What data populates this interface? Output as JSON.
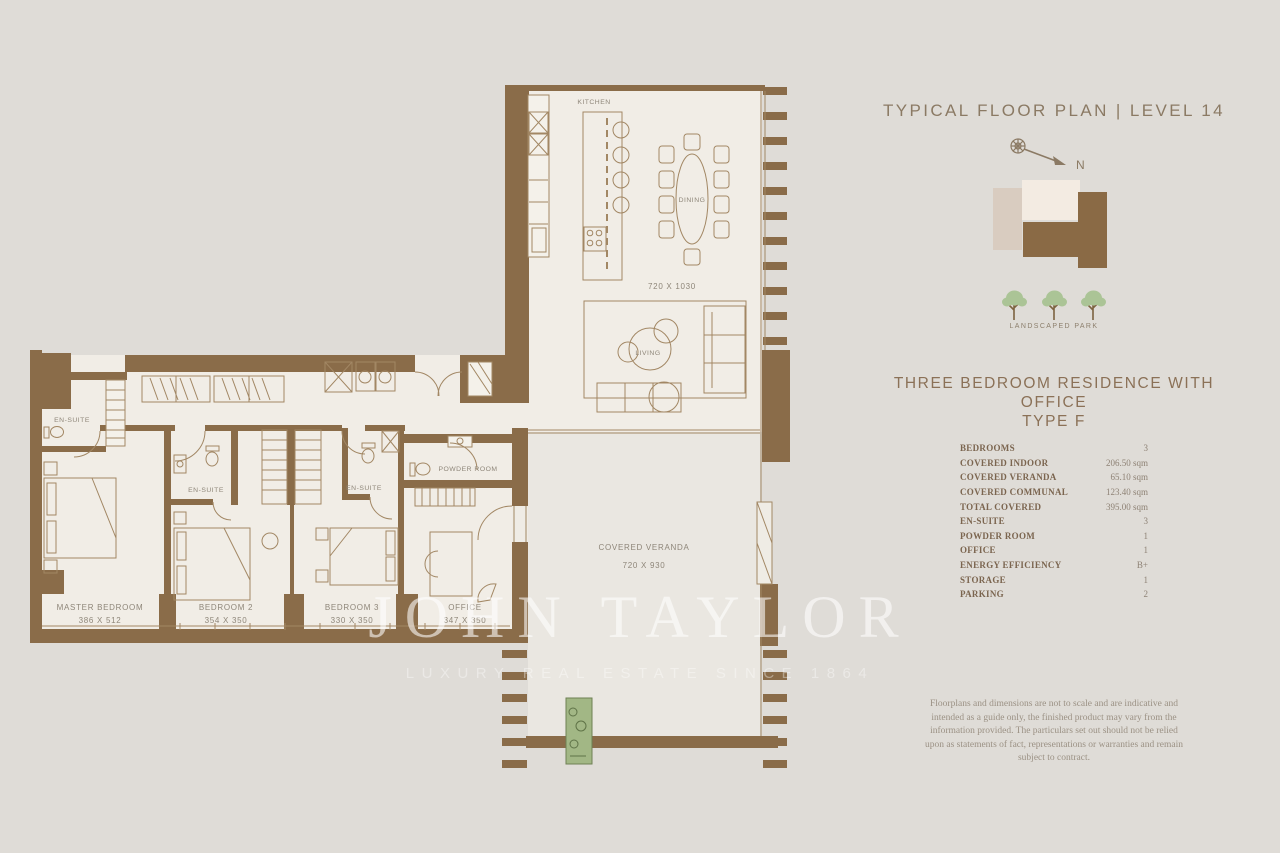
{
  "plan": {
    "labels": {
      "kitchen": "KITCHEN",
      "dining": "DINING",
      "dining_area_dims": "720 X 1030",
      "living": "LIVING",
      "covered_veranda": "COVERED VERANDA",
      "veranda_dims": "720 X 930",
      "master_bedroom": "MASTER BEDROOM",
      "master_dims": "386 X 512",
      "bedroom2": "BEDROOM 2",
      "bedroom2_dims": "354 X 350",
      "bedroom3": "BEDROOM 3",
      "bedroom3_dims": "330 X 350",
      "office": "OFFICE",
      "office_dims": "347 X 350",
      "ensuite_master": "EN-SUITE",
      "ensuite_bedroom2": "EN-SUITE",
      "ensuite_bedroom3": "EN-SUITE",
      "powder_room": "POWDER ROOM"
    }
  },
  "watermark": {
    "line1": "JOHN TAYLOR",
    "line2": "LUXURY REAL ESTATE SINCE 1864"
  },
  "panel": {
    "title": "TYPICAL FLOOR PLAN | LEVEL 14",
    "compass_label": "N",
    "park_label": "LANDSCAPED PARK",
    "heading_line1": "THREE BEDROOM RESIDENCE WITH OFFICE",
    "heading_line2": "TYPE F",
    "specs": [
      {
        "label": "BEDROOMS",
        "value": "3"
      },
      {
        "label": "COVERED INDOOR",
        "value": "206.50 sqm"
      },
      {
        "label": "COVERED VERANDA",
        "value": "65.10 sqm"
      },
      {
        "label": "COVERED COMMUNAL",
        "value": "123.40 sqm"
      },
      {
        "label": "TOTAL COVERED",
        "value": "395.00 sqm"
      },
      {
        "label": "EN-SUITE",
        "value": "3"
      },
      {
        "label": "POWDER ROOM",
        "value": "1"
      },
      {
        "label": "OFFICE",
        "value": "1"
      },
      {
        "label": "ENERGY EFFICIENCY",
        "value": "B+"
      },
      {
        "label": "STORAGE",
        "value": "1"
      },
      {
        "label": "PARKING",
        "value": "2"
      }
    ],
    "disclaimer": "Floorplans and dimensions are not to scale and are indicative and intended as a guide only, the finished product may vary from the information provided. The particulars set out should not be relied upon as statements of fact, representations or warranties and remain subject to contract."
  },
  "colors": {
    "background": "#dfdcd7",
    "wall_brown": "#8a6c49",
    "floor_cream": "#f1ede6",
    "accent_text": "#8b7157",
    "tree_green": "#abc496",
    "planter_green": "#a2b785"
  }
}
